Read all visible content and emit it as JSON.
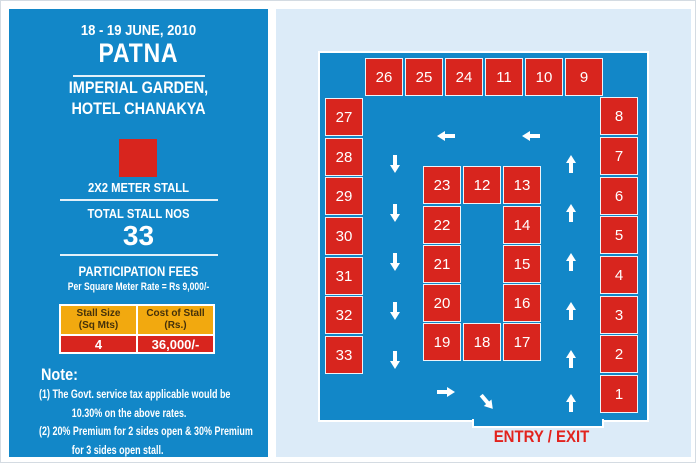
{
  "colors": {
    "panel_blue": "#1287c8",
    "stall_red": "#d8251e",
    "table_yellow": "#f2a90f",
    "light_blue_bg": "#dcebf8",
    "entry_red": "#e2231e",
    "text_white": "#ffffff"
  },
  "left_panel": {
    "date": "18 - 19 JUNE, 2010",
    "city": "PATNA",
    "venue_line1": "IMPERIAL GARDEN,",
    "venue_line2": "HOTEL CHANAKYA",
    "stall_legend": "2X2 METER STALL",
    "total_label": "TOTAL STALL NOS",
    "total_value": "33",
    "fees_title": "PARTICIPATION FEES",
    "fees_rate": "Per Square Meter Rate = Rs 9,000/-",
    "table": {
      "header_size": "Stall Size\n(Sq Mts)",
      "header_cost": "Cost of Stall\n(Rs.)",
      "row_size": "4",
      "row_cost": "36,000/-"
    },
    "note_title": "Note:",
    "notes": [
      "(1) The Govt. service tax applicable would be",
      "10.30% on the above rates.",
      "(2) 20% Premium for 2 sides open & 30% Premium",
      "for 3 sides open stall."
    ]
  },
  "floor_plan": {
    "entry_label": "ENTRY / EXIT",
    "stalls": [
      {
        "n": "26",
        "x": 364,
        "y": 57
      },
      {
        "n": "25",
        "x": 404,
        "y": 57
      },
      {
        "n": "24",
        "x": 444,
        "y": 57
      },
      {
        "n": "11",
        "x": 484,
        "y": 57
      },
      {
        "n": "10",
        "x": 524,
        "y": 57
      },
      {
        "n": "9",
        "x": 564,
        "y": 57
      },
      {
        "n": "27",
        "x": 324,
        "y": 97
      },
      {
        "n": "28",
        "x": 324,
        "y": 137
      },
      {
        "n": "29",
        "x": 324,
        "y": 176
      },
      {
        "n": "30",
        "x": 324,
        "y": 216
      },
      {
        "n": "31",
        "x": 324,
        "y": 256
      },
      {
        "n": "32",
        "x": 324,
        "y": 295
      },
      {
        "n": "33",
        "x": 324,
        "y": 335
      },
      {
        "n": "8",
        "x": 599,
        "y": 96
      },
      {
        "n": "7",
        "x": 599,
        "y": 136
      },
      {
        "n": "6",
        "x": 599,
        "y": 176
      },
      {
        "n": "5",
        "x": 599,
        "y": 215
      },
      {
        "n": "4",
        "x": 599,
        "y": 255
      },
      {
        "n": "3",
        "x": 599,
        "y": 295
      },
      {
        "n": "2",
        "x": 599,
        "y": 334
      },
      {
        "n": "1",
        "x": 599,
        "y": 374
      },
      {
        "n": "23",
        "x": 422,
        "y": 165
      },
      {
        "n": "12",
        "x": 462,
        "y": 165
      },
      {
        "n": "13",
        "x": 502,
        "y": 165
      },
      {
        "n": "22",
        "x": 422,
        "y": 205
      },
      {
        "n": "14",
        "x": 502,
        "y": 205
      },
      {
        "n": "21",
        "x": 422,
        "y": 244
      },
      {
        "n": "15",
        "x": 502,
        "y": 244
      },
      {
        "n": "20",
        "x": 422,
        "y": 283
      },
      {
        "n": "16",
        "x": 502,
        "y": 283
      },
      {
        "n": "19",
        "x": 422,
        "y": 322
      },
      {
        "n": "18",
        "x": 462,
        "y": 322
      },
      {
        "n": "17",
        "x": 502,
        "y": 322
      }
    ],
    "arrows": [
      {
        "dir": "left",
        "cx": 445,
        "cy": 135
      },
      {
        "dir": "left",
        "cx": 530,
        "cy": 135
      },
      {
        "dir": "down",
        "cx": 394,
        "cy": 163
      },
      {
        "dir": "down",
        "cx": 394,
        "cy": 212
      },
      {
        "dir": "down",
        "cx": 394,
        "cy": 261
      },
      {
        "dir": "down",
        "cx": 394,
        "cy": 310
      },
      {
        "dir": "down",
        "cx": 394,
        "cy": 359
      },
      {
        "dir": "up",
        "cx": 570,
        "cy": 163
      },
      {
        "dir": "up",
        "cx": 570,
        "cy": 212
      },
      {
        "dir": "up",
        "cx": 570,
        "cy": 261
      },
      {
        "dir": "up",
        "cx": 570,
        "cy": 310
      },
      {
        "dir": "up",
        "cx": 570,
        "cy": 358
      },
      {
        "dir": "up",
        "cx": 570,
        "cy": 402
      },
      {
        "dir": "right",
        "cx": 445,
        "cy": 391
      },
      {
        "dir": "diag",
        "cx": 486,
        "cy": 401
      }
    ]
  }
}
